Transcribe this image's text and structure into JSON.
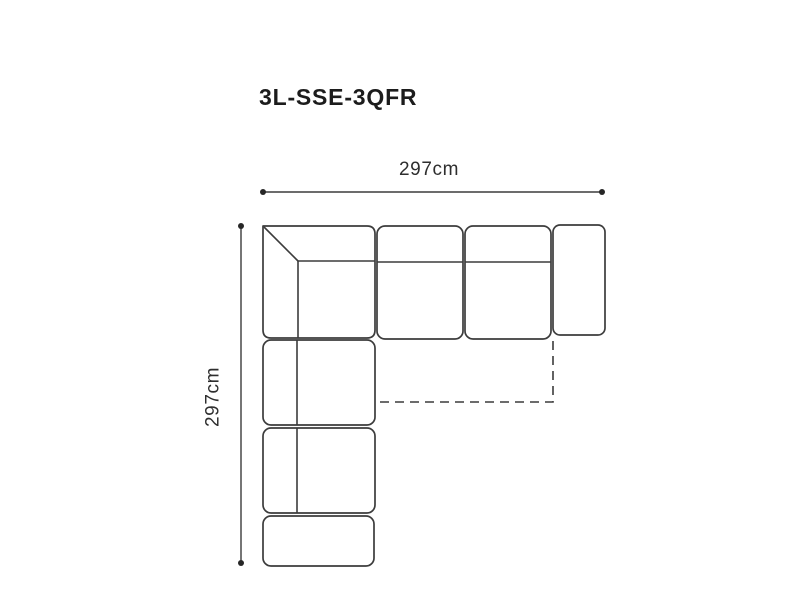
{
  "diagram": {
    "title": "3L-SSE-3QFR",
    "colors": {
      "line": "#3c3c3c",
      "text": "#1c1c1c",
      "background": "#ffffff"
    },
    "dimension_width": {
      "label": "297cm"
    },
    "dimension_depth": {
      "label": "297cm"
    },
    "sofa": {
      "corner_unit": {
        "x": 263,
        "y": 226,
        "w": 112,
        "h": 112,
        "r": 8,
        "inner_x": 298,
        "inner_y": 261
      },
      "units": [
        {
          "name": "seat-top-1",
          "x": 377,
          "y": 226,
          "w": 86,
          "h": 113,
          "r": 8,
          "divider": {
            "orient": "h",
            "pos": 262
          }
        },
        {
          "name": "seat-top-2",
          "x": 465,
          "y": 226,
          "w": 86,
          "h": 113,
          "r": 8,
          "divider": {
            "orient": "h",
            "pos": 262
          }
        },
        {
          "name": "arm-right",
          "x": 553,
          "y": 225,
          "w": 52,
          "h": 110,
          "r": 7
        },
        {
          "name": "seat-left-1",
          "x": 263,
          "y": 340,
          "w": 112,
          "h": 85,
          "r": 8,
          "divider": {
            "orient": "v",
            "pos": 297
          }
        },
        {
          "name": "seat-left-2",
          "x": 263,
          "y": 428,
          "w": 112,
          "h": 85,
          "r": 8,
          "divider": {
            "orient": "v",
            "pos": 297
          }
        },
        {
          "name": "arm-bottom",
          "x": 263,
          "y": 516,
          "w": 111,
          "h": 50,
          "r": 8
        }
      ],
      "chaise_dashed": {
        "points": "553,341 553,402 377,402"
      }
    },
    "dimension_geometry": {
      "horizontal": {
        "x1": 263,
        "x2": 602,
        "y": 192,
        "label_x": 429,
        "label_y": 175
      },
      "vertical": {
        "x": 241,
        "y1": 226,
        "y2": 563,
        "label_x": 213,
        "label_y": 397
      }
    }
  }
}
